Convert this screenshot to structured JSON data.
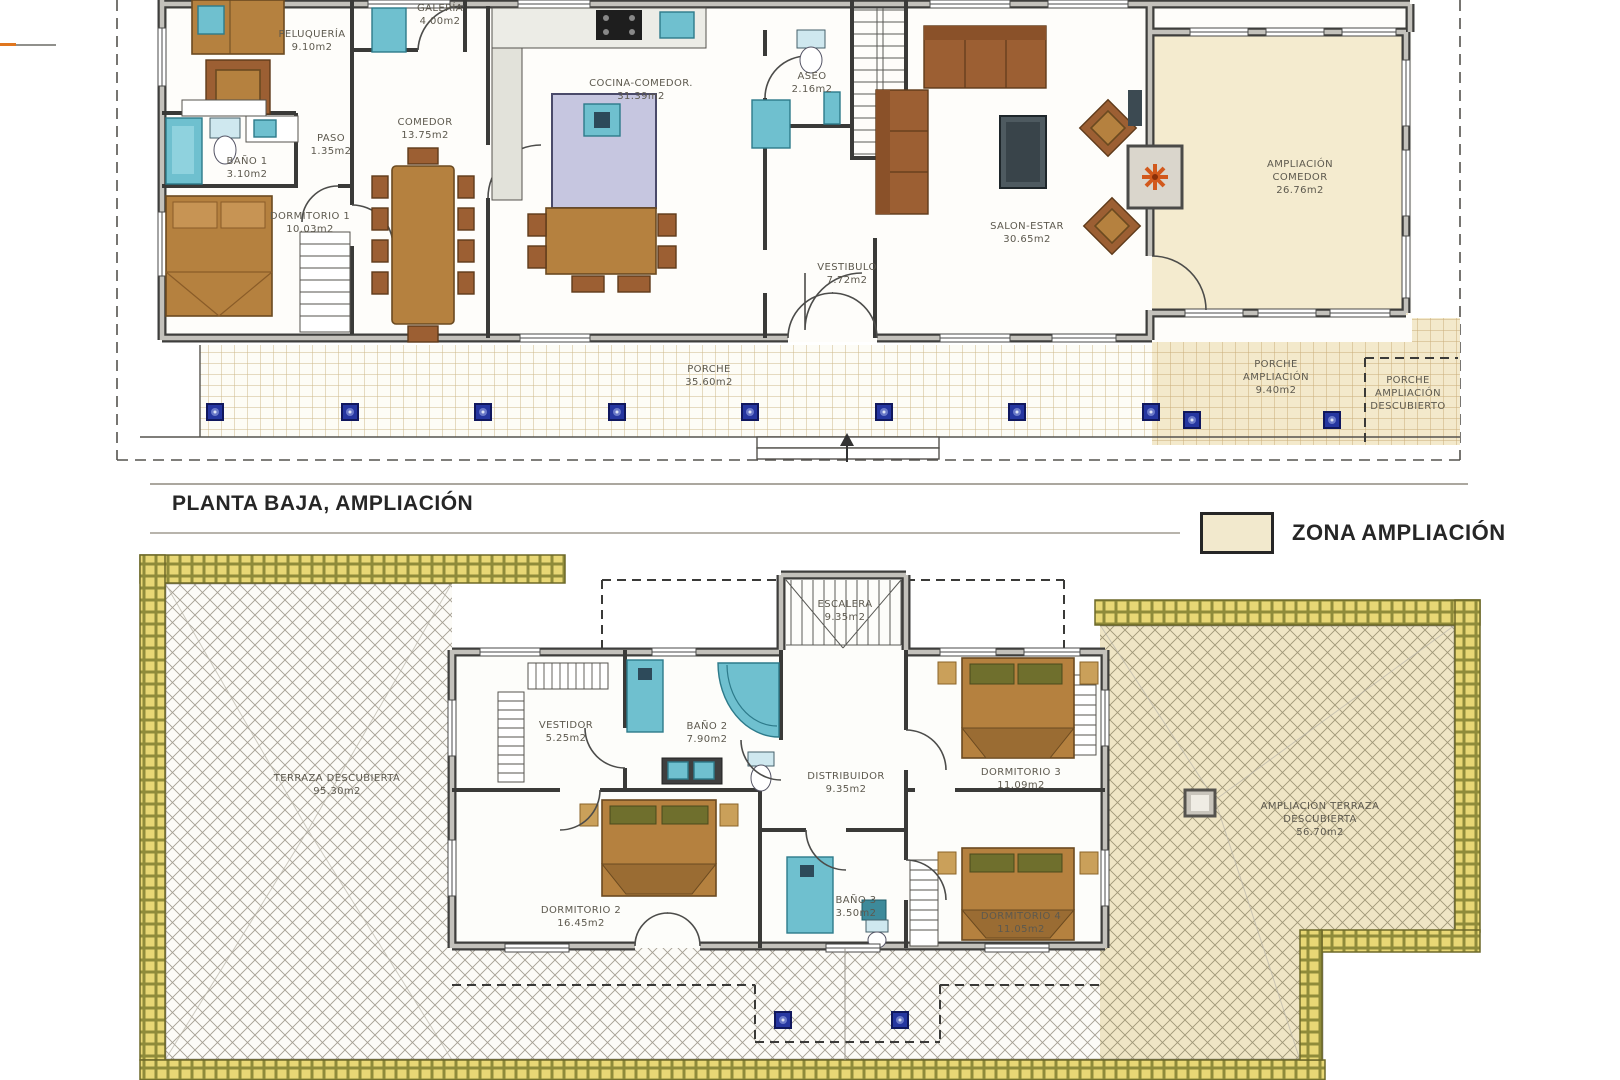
{
  "page": {
    "title": "PLANTA BAJA, AMPLIACIÓN"
  },
  "legend": {
    "label": "ZONA AMPLIACIÓN",
    "swatch_color": "#f2e9cd"
  },
  "ground_floor": {
    "rooms": [
      {
        "name": "PELUQUERÍA",
        "area": "9.10m2"
      },
      {
        "name": "GALERÍA",
        "area": "4.00m2"
      },
      {
        "name": "COMEDOR",
        "area": "13.75m2"
      },
      {
        "name": "BAÑO 1",
        "area": "3.10m2"
      },
      {
        "name": "PASO",
        "area": "1.35m2"
      },
      {
        "name": "DORMITORIO 1",
        "area": "10.03m2"
      },
      {
        "name": "COCINA-COMEDOR.",
        "area": "31.39m2"
      },
      {
        "name": "ASEO",
        "area": "2.16m2"
      },
      {
        "name": "VESTIBULO",
        "area": "7.72m2"
      },
      {
        "name": "SALON-ESTAR",
        "area": "30.65m2"
      },
      {
        "name": "AMPLIACIÓN COMEDOR",
        "area": "26.76m2"
      },
      {
        "name": "PORCHE",
        "area": "35.60m2"
      },
      {
        "name": "PORCHE AMPLIACIÓN",
        "area": "9.40m2"
      },
      {
        "name": "PORCHE AMPLIACIÓN DESCUBIERTO",
        "area": ""
      }
    ]
  },
  "first_floor": {
    "rooms": [
      {
        "name": "ESCALERA",
        "area": "9.35m2"
      },
      {
        "name": "VESTIDOR",
        "area": "5.25m2"
      },
      {
        "name": "BAÑO 2",
        "area": "7.90m2"
      },
      {
        "name": "DISTRIBUIDOR",
        "area": "9.35m2"
      },
      {
        "name": "DORMITORIO 3",
        "area": "11.09m2"
      },
      {
        "name": "DORMITORIO 2",
        "area": "16.45m2"
      },
      {
        "name": "BAÑO 3",
        "area": "3.50m2"
      },
      {
        "name": "DORMITORIO 4",
        "area": "11.05m2"
      },
      {
        "name": "TERRAZA DESCUBIERTA",
        "area": "95.30m2"
      },
      {
        "name": "AMPLIACIÓN TERRAZA DESCUBIERTA",
        "area": "56.70m2"
      }
    ]
  },
  "colors": {
    "zona_ampliacion": "#f2e9cd",
    "walls": "#3e3e3c",
    "sanitary_teal": "#6fc0cf",
    "wood_furniture": "#b5813f",
    "sofa_brown": "#9c5f33",
    "column_marker_blue": "#2636a0",
    "terrace_border_gold": "#e8d775",
    "fireplace_orange": "#d2591c"
  }
}
